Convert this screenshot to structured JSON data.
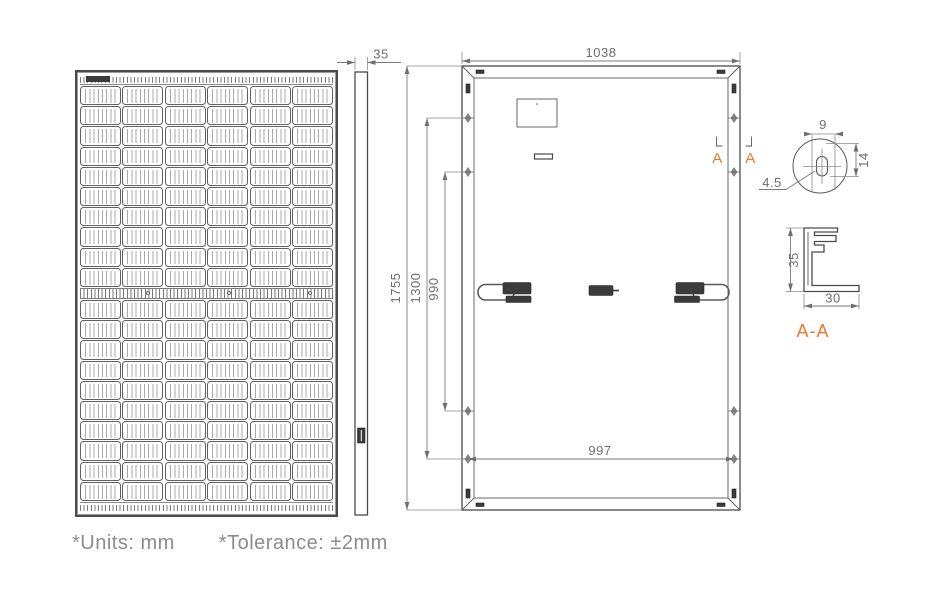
{
  "colors": {
    "object_line": "#4a4a4a",
    "dimension_line": "#7a7a7a",
    "dimension_text": "#6e6e6e",
    "accent_orange": "#e87b2a",
    "footer_text": "#8c8c8c",
    "dark_fill": "#3b3b3b",
    "background": "#ffffff"
  },
  "front_view": {
    "columns": 6,
    "rows_top": 10,
    "rows_bottom": 10
  },
  "side_view": {
    "thickness_label": "35"
  },
  "back_view": {
    "width_label": "1038",
    "mount_span_label": "997",
    "height_label": "1755",
    "outer_hole_span_label": "1300",
    "inner_hole_span_label": "990",
    "section_marker_left": "A",
    "section_marker_right": "A"
  },
  "hole_detail": {
    "slot_width_label": "9",
    "slot_length_label": "14",
    "hole_diameter_label": "4.5"
  },
  "frame_section": {
    "title": "A-A",
    "height_label": "35",
    "width_label": "30"
  },
  "footer": {
    "units_note": "*Units: mm",
    "tolerance_note": "*Tolerance: ±2mm"
  }
}
